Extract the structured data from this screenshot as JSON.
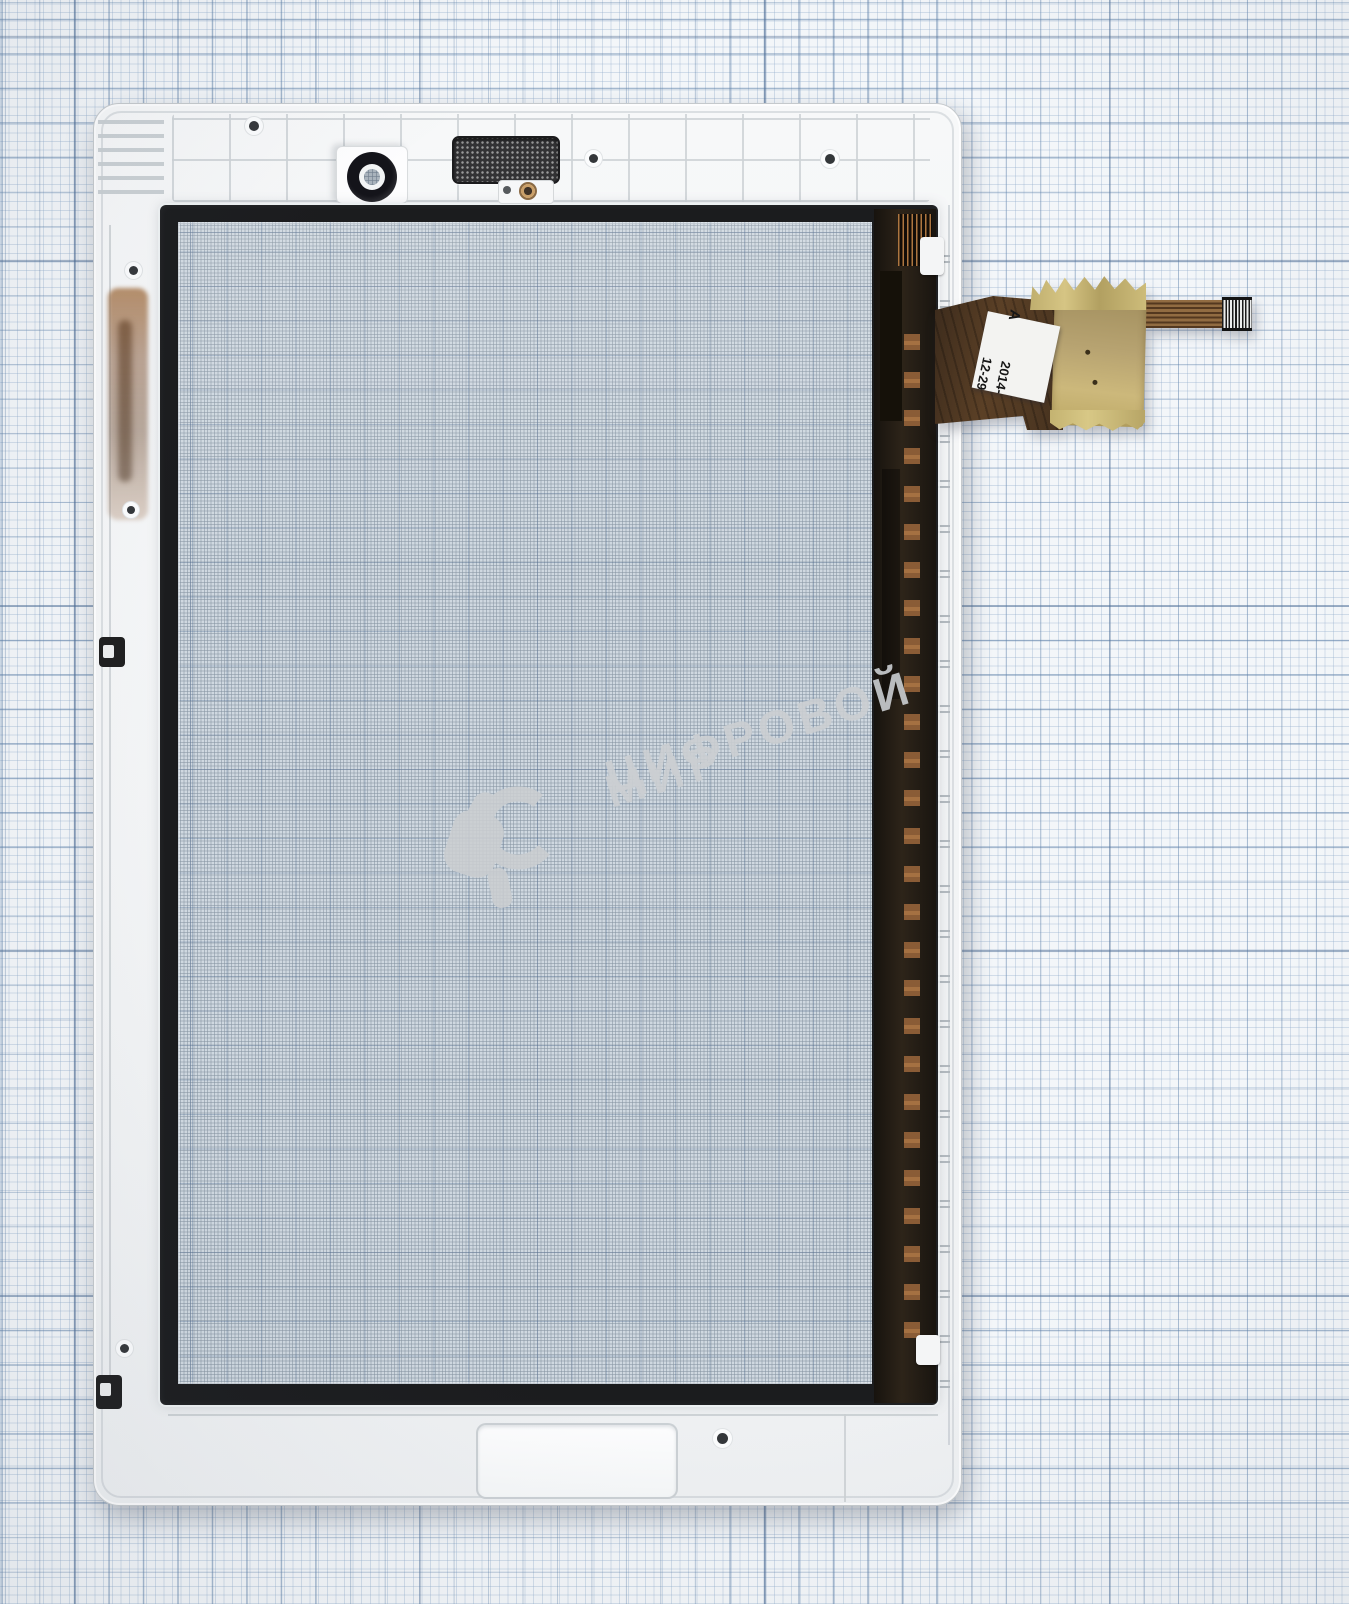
{
  "watermark": {
    "line1": "ЦИФРОВОЙ",
    "line2": "МИР"
  },
  "flex_label": {
    "line1": "2014-12-29",
    "line2": "A"
  },
  "colors": {
    "paper-bg": "#f3f6f9",
    "paper-minor": "#aac2da",
    "paper-major": "#5c7ea6",
    "frame-white": "#f4f5f6",
    "frame-line": "#ccd0d3",
    "bezel-black": "#1b1c1e",
    "glass-bg": "#cfd8e0",
    "glass-mesh": "#8e9fae",
    "strip-dark": "#241e17",
    "copper": "#8a5c36",
    "flex-brown": "#52391f",
    "kapton": "#b7a371",
    "gold-tape": "#c9b878",
    "label-bg": "#f3f3f1",
    "label-text": "#161616",
    "watermark-gray": "#cbced1"
  }
}
